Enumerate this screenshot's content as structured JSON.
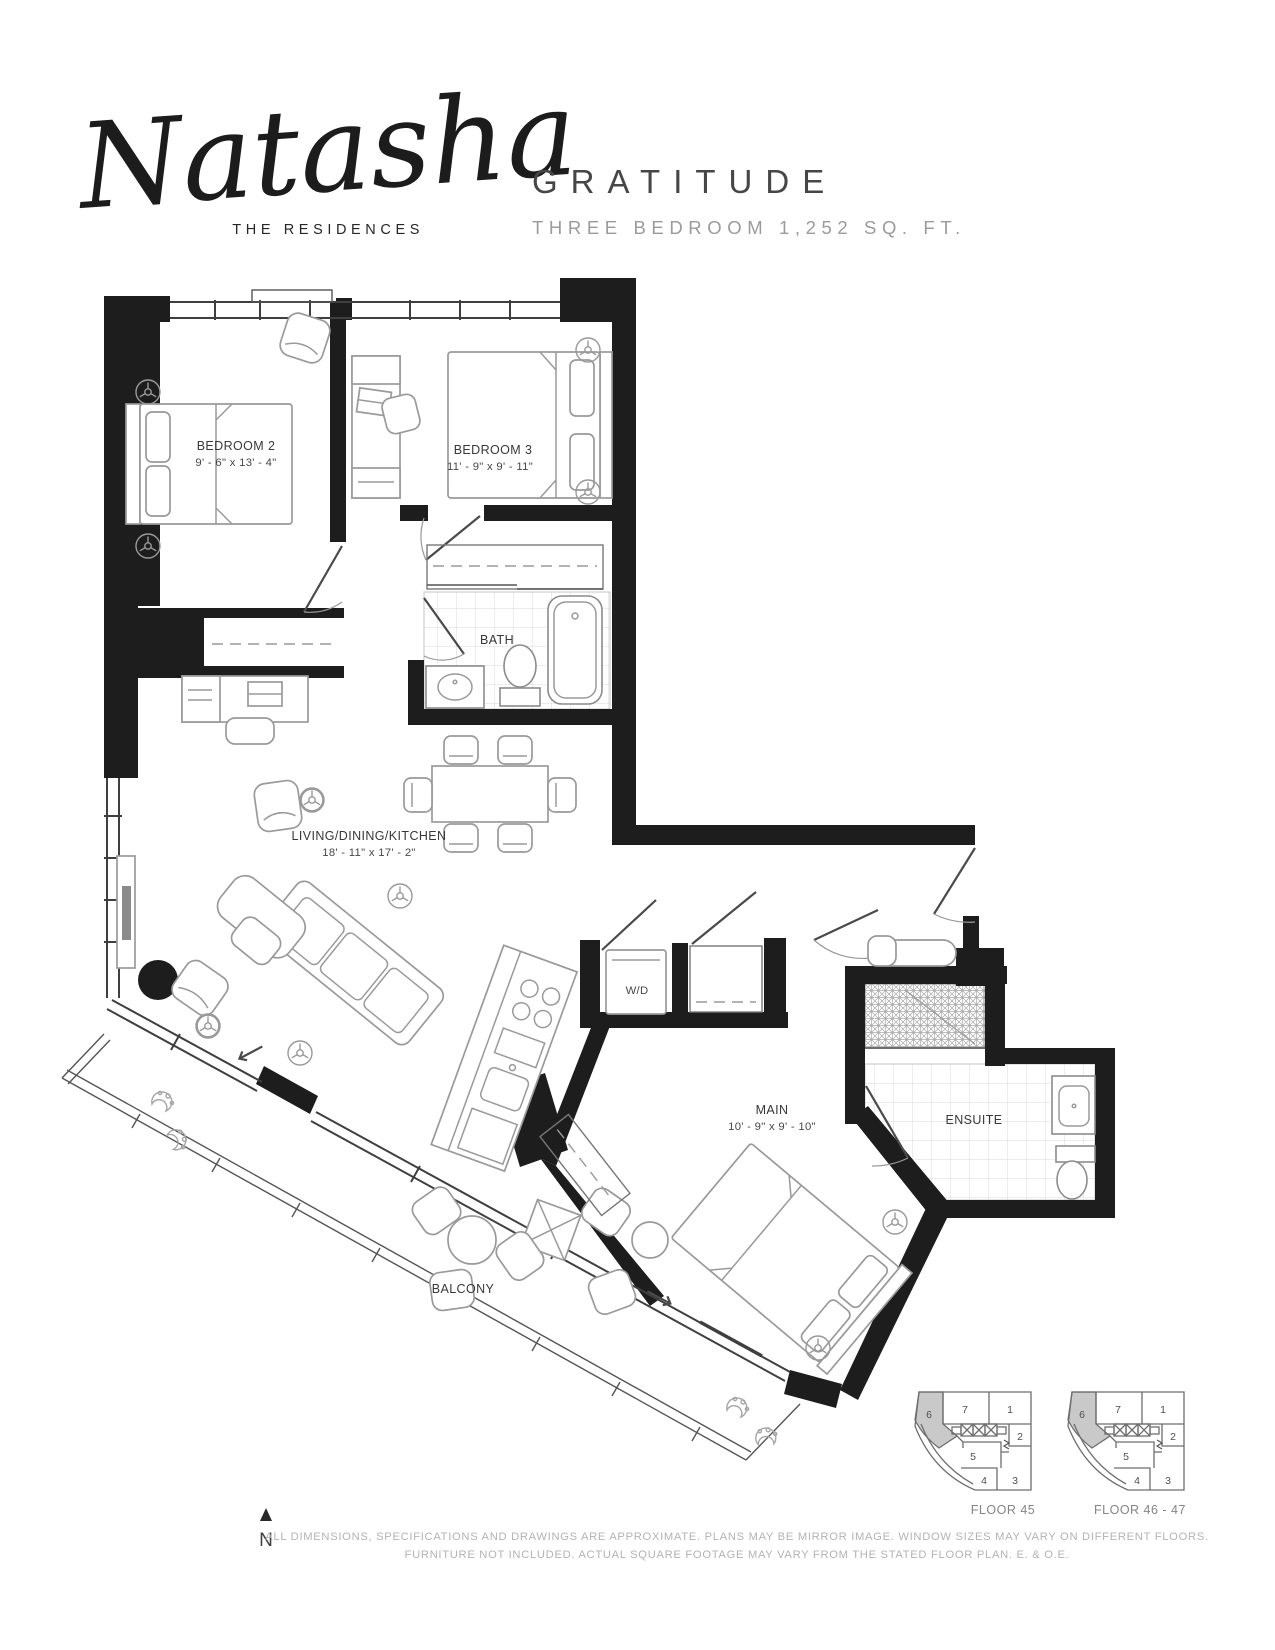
{
  "header": {
    "logo_script": "Natasha",
    "logo_sub": "THE RESIDENCES",
    "plan_name": "GRATITUDE",
    "plan_spec": "THREE BEDROOM 1,252 SQ. FT."
  },
  "rooms": {
    "bedroom2": {
      "name": "BEDROOM 2",
      "dims": "9' - 6\" x 13' - 4\""
    },
    "bedroom3": {
      "name": "BEDROOM 3",
      "dims": "11' - 9\" x 9' - 11\""
    },
    "bath": {
      "name": "BATH"
    },
    "living": {
      "name": "LIVING/DINING/KITCHEN",
      "dims": "18' - 11\" x 17' - 2\""
    },
    "wd": {
      "name": "W/D"
    },
    "main": {
      "name": "MAIN",
      "dims": "10' - 9\" x 9' - 10\""
    },
    "ensuite": {
      "name": "ENSUITE"
    },
    "balcony": {
      "name": "BALCONY"
    }
  },
  "keyplan": {
    "units": {
      "u1": "1",
      "u2": "2",
      "u3": "3",
      "u4": "4",
      "u5": "5",
      "u6": "6",
      "u7": "7"
    },
    "floors": {
      "left": "FLOOR 45",
      "right": "FLOOR 46 - 47"
    }
  },
  "compass": {
    "n": "N"
  },
  "disclaimer": {
    "line1": "ALL DIMENSIONS, SPECIFICATIONS AND DRAWINGS ARE APPROXIMATE. PLANS MAY BE MIRROR IMAGE. WINDOW SIZES MAY VARY ON DIFFERENT FLOORS.",
    "line2": "FURNITURE NOT INCLUDED. ACTUAL SQUARE FOOTAGE MAY VARY FROM THE STATED FLOOR PLAN. E. & O.E."
  },
  "colors": {
    "wall": "#1d1d1d",
    "furniture": "#9a9a9a",
    "shade": "#c9c9c9",
    "label": "#383838",
    "disclaimer": "#b3b3b3"
  }
}
